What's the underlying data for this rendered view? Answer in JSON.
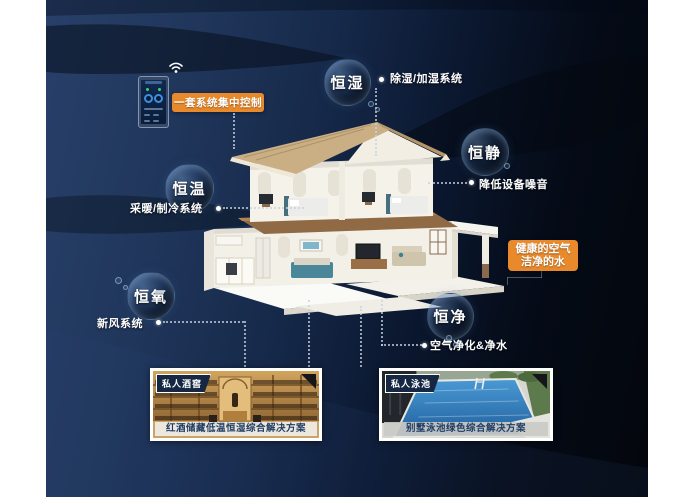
{
  "colors": {
    "accent": "#e8892b",
    "background_navy": "#20365b",
    "caption_text": "#1e3c64"
  },
  "control": {
    "label": "一套系统集中控制",
    "device": "smart-home-control-phone",
    "wifi_icon": "wifi"
  },
  "features": {
    "humidity": {
      "bubble": "恒湿",
      "desc": "除湿/加湿系统"
    },
    "quiet": {
      "bubble": "恒静",
      "desc": "降低设备噪音"
    },
    "temperature": {
      "bubble": "恒温",
      "desc": "采暖/制冷系统"
    },
    "oxygen": {
      "bubble": "恒氧",
      "desc": "新风系统"
    },
    "purity": {
      "bubble": "恒净",
      "desc": "空气净化&净水"
    }
  },
  "highlight": {
    "line1": "健康的空气",
    "line2": "洁净的水"
  },
  "cases": {
    "wine": {
      "tag": "私人酒窖",
      "caption": "红酒储藏低温恒湿综合解决方案"
    },
    "pool": {
      "tag": "私人泳池",
      "caption": "别墅泳池绿色综合解决方案"
    }
  }
}
